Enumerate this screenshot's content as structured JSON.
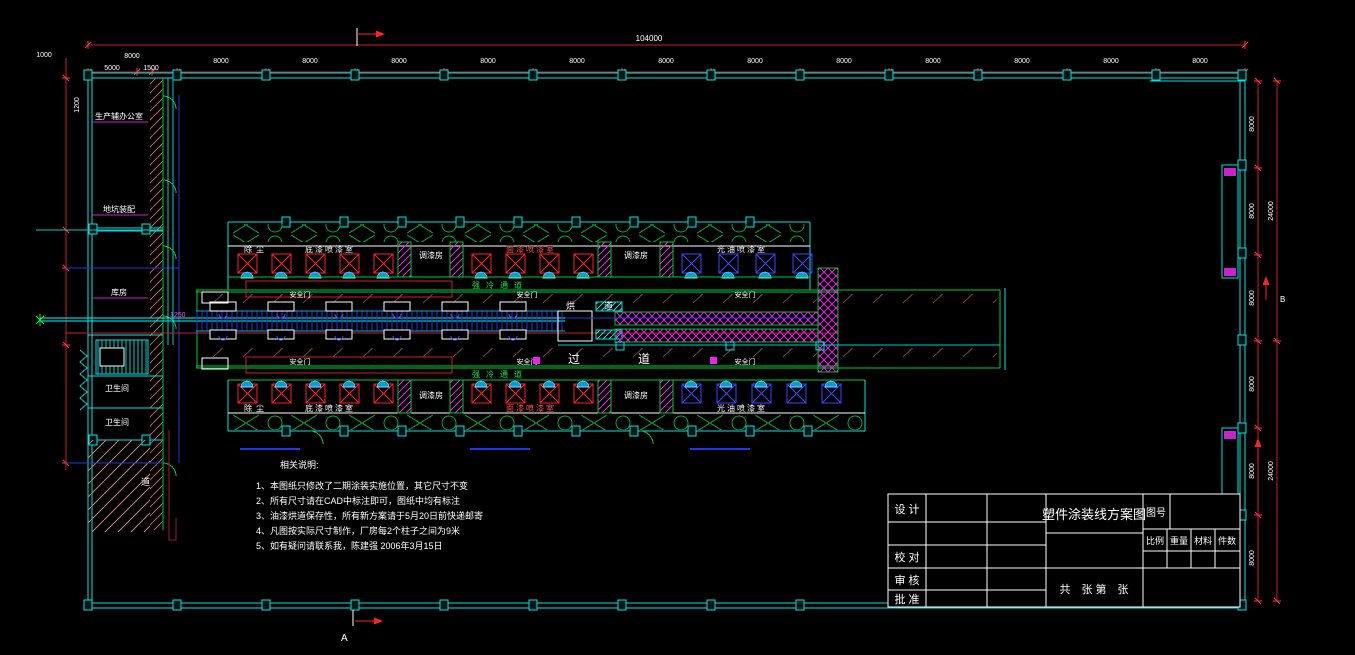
{
  "drawing": {
    "type": "factory-floor-plan-cad"
  },
  "dims": {
    "total": "104000",
    "bay": "8000",
    "sub_a": "5000",
    "sub_b": "1500",
    "left_a": "1000",
    "left_b": "1200",
    "right_total": "24000",
    "conveyor": "1250"
  },
  "markers": {
    "a": "A",
    "b": "B"
  },
  "left_wing": {
    "rooms": [
      "生产辅办公室",
      "地坑装配",
      "库房",
      "卫生间",
      "卫生间"
    ],
    "ramp": "道"
  },
  "line": {
    "rooms": [
      "除尘",
      "底漆喷漆室",
      "调漆房",
      "面漆喷漆室",
      "调漆房",
      "光油喷漆室"
    ],
    "cold": "强冷通道",
    "oven_a": "烘",
    "oven_b": "道",
    "pass_a": "过",
    "pass_b": "道",
    "safety": "安全门"
  },
  "notes": {
    "heading": "相关说明:",
    "items": [
      "1、本图纸只修改了二期涂装实施位置，其它尺寸不变",
      "2、所有尺寸请在CAD中标注即可，图纸中均有标注",
      "3、油漆烘道保存性，所有新方案请于5月20日前快递邮寄",
      "4、凡图按实际尺寸制作，厂房每2个柱子之间为9米",
      "5、如有疑问请联系我，陈建强 2006年3月15日"
    ]
  },
  "title_block": {
    "design": "设 计",
    "check": "校 对",
    "review": "审 核",
    "approve": "批 准",
    "title": "塑件涂装线方案图",
    "no_label": "图号",
    "headers": [
      "比例",
      "重量",
      "材料",
      "件数"
    ],
    "sheet": "共　张 第　张"
  },
  "colors": {
    "wall": "#00e5e5",
    "dimension": "#ff3333",
    "green_wall": "#00cc33",
    "oven_hatch": "#ee22ee",
    "conveyor": "#2238dd",
    "text": "#ffffff"
  }
}
